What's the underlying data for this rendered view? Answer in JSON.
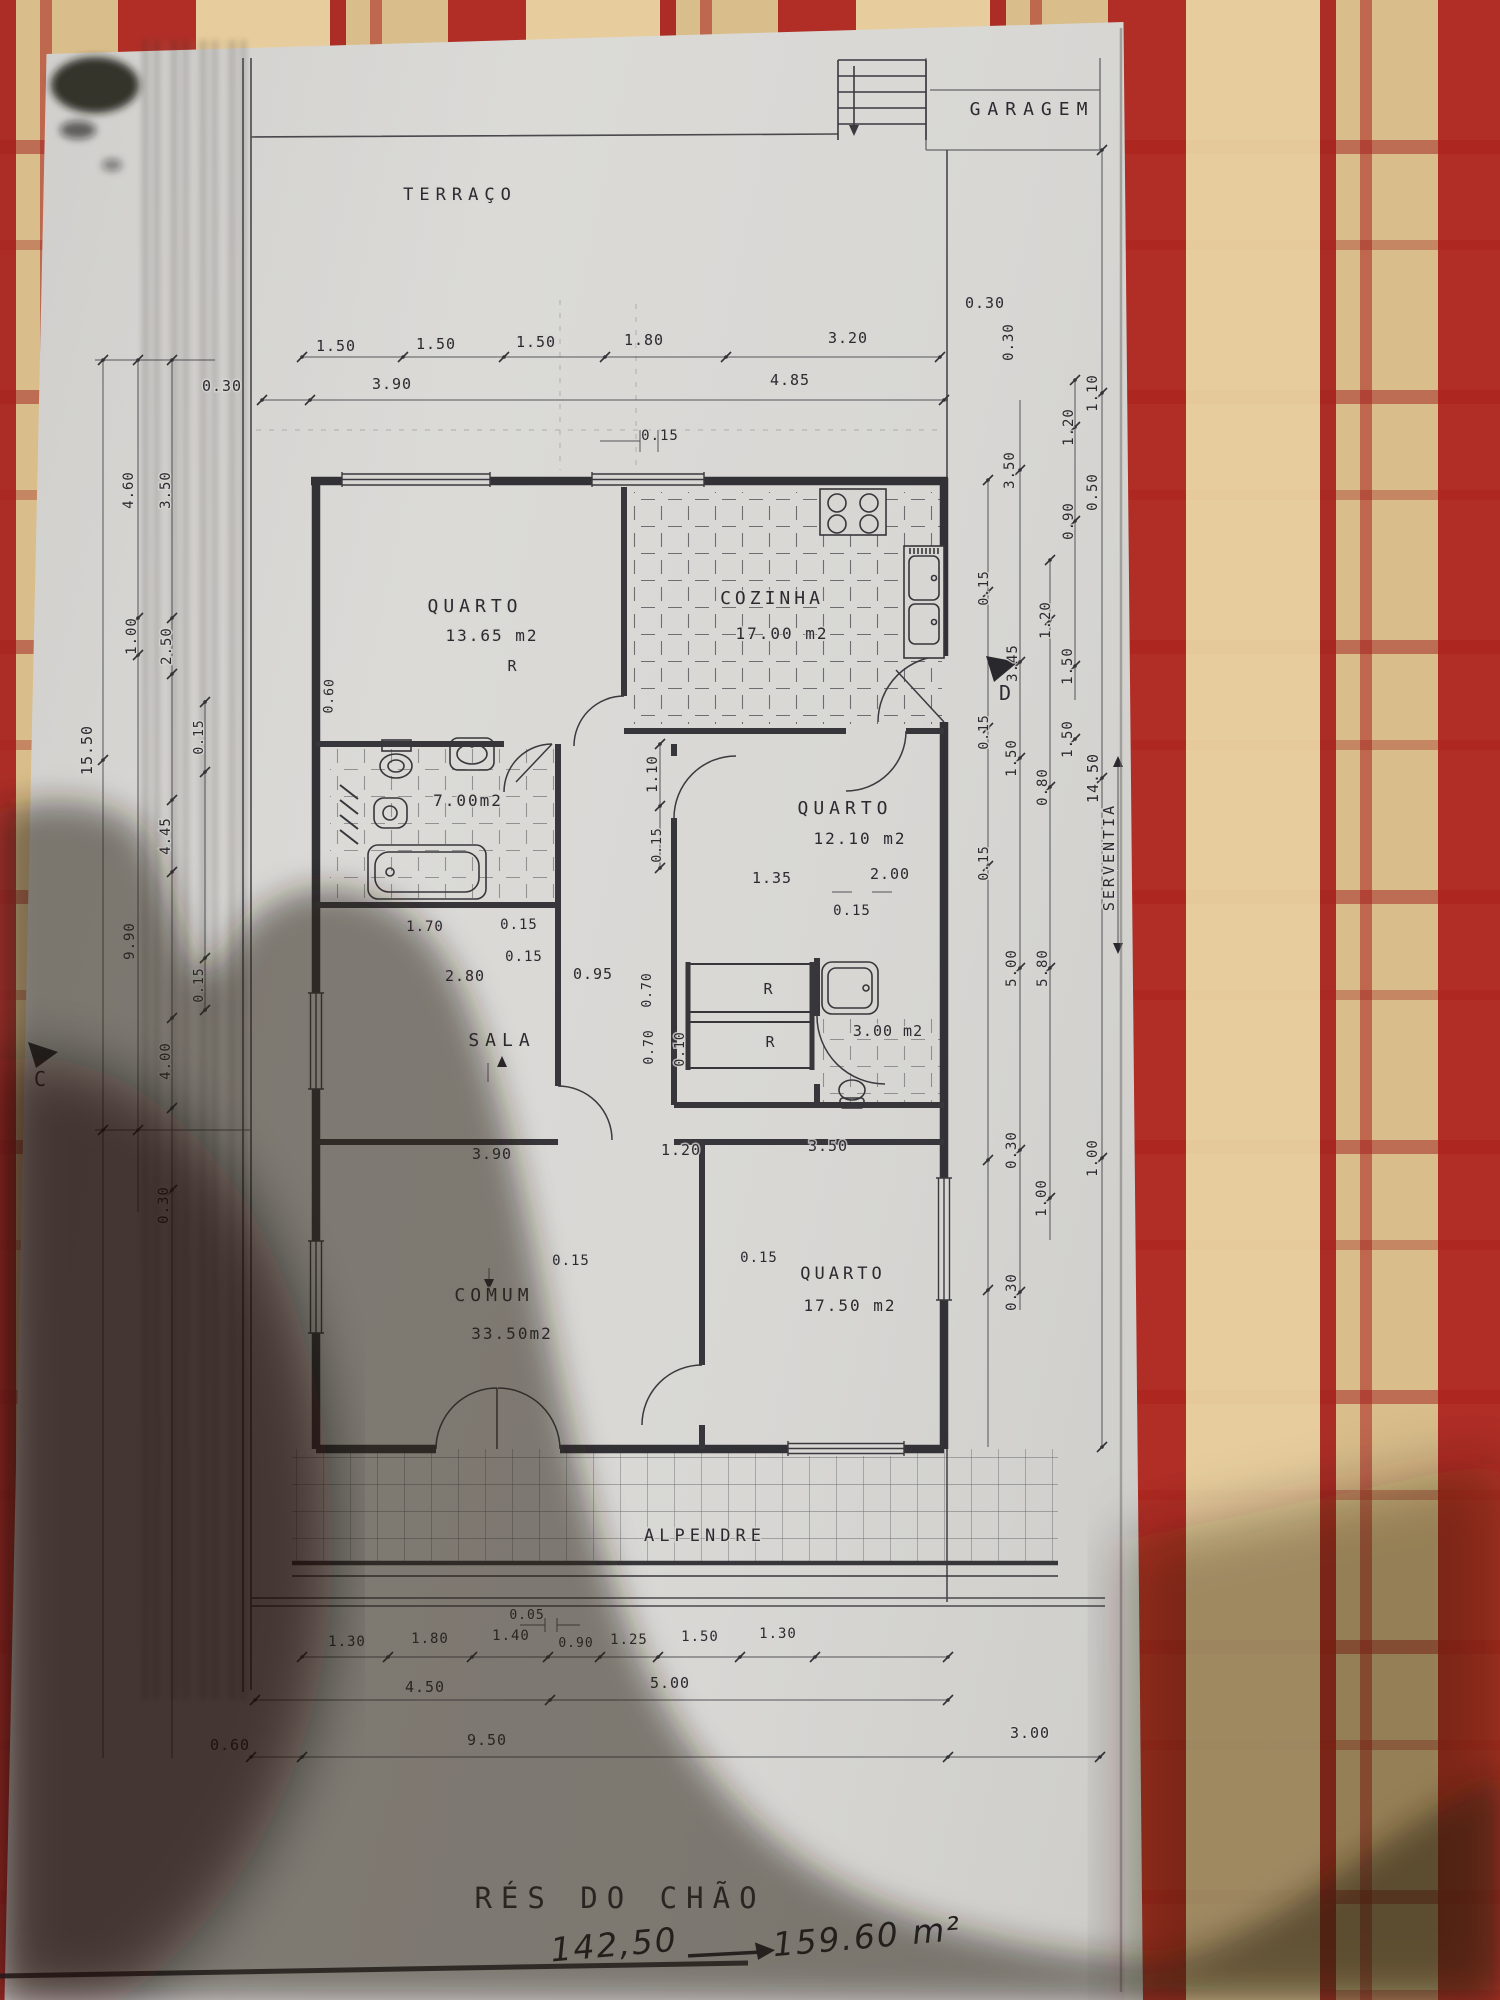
{
  "plan": {
    "title": "RÉS DO CHÃO",
    "handwriting": {
      "before_value": "142,50",
      "after_value": "159.60 m²"
    },
    "room_labels": [
      "GARAGEM",
      "TERRAÇO",
      "QUARTO 13.65 m2",
      "COZINHA 17.00 m2",
      "7.00m2",
      "QUARTO 12.10 m2",
      "SALA",
      "3.00 m2",
      "COMUM 33.50m2",
      "QUARTO 17.50 m2",
      "ALPENDRE",
      "SERVENTIA"
    ],
    "section_markers": [
      "C",
      "D"
    ],
    "labels": [
      {
        "id": "garagem-label",
        "text": "GARAGEM",
        "x": 1032,
        "y": 115,
        "rot": 0,
        "size": 18,
        "ls": 7
      },
      {
        "id": "terraco-label",
        "text": "TERRAÇO",
        "x": 460,
        "y": 200,
        "rot": 0,
        "size": 17,
        "ls": 6
      },
      {
        "id": "dim-150a",
        "text": "1.50",
        "x": 336,
        "y": 351,
        "rot": 0,
        "size": 15,
        "ls": 1
      },
      {
        "id": "dim-150b",
        "text": "1.50",
        "x": 436,
        "y": 349,
        "rot": 0,
        "size": 15,
        "ls": 1
      },
      {
        "id": "dim-150c",
        "text": "1.50",
        "x": 536,
        "y": 347,
        "rot": 0,
        "size": 15,
        "ls": 1
      },
      {
        "id": "dim-180",
        "text": "1.80",
        "x": 644,
        "y": 345,
        "rot": 0,
        "size": 15,
        "ls": 1
      },
      {
        "id": "dim-320",
        "text": "3.20",
        "x": 848,
        "y": 343,
        "rot": 0,
        "size": 15,
        "ls": 1
      },
      {
        "id": "dim-030-left",
        "text": "0.30",
        "x": 222,
        "y": 391,
        "rot": 0,
        "size": 15,
        "ls": 1
      },
      {
        "id": "dim-390",
        "text": "3.90",
        "x": 392,
        "y": 389,
        "rot": 0,
        "size": 15,
        "ls": 1
      },
      {
        "id": "dim-485",
        "text": "4.85",
        "x": 790,
        "y": 385,
        "rot": 0,
        "size": 15,
        "ls": 1
      },
      {
        "id": "dim-030-right-top",
        "text": "0.30",
        "x": 985,
        "y": 308,
        "rot": 0,
        "size": 15,
        "ls": 1
      },
      {
        "id": "dim-015-top",
        "text": "0.15",
        "x": 660,
        "y": 440,
        "rot": 0,
        "size": 14,
        "ls": 1
      },
      {
        "id": "quarto1-name",
        "text": "QUARTO",
        "x": 475,
        "y": 612,
        "rot": 0,
        "size": 18,
        "ls": 5
      },
      {
        "id": "quarto1-area",
        "text": "13.65 m2",
        "x": 492,
        "y": 641,
        "rot": 0,
        "size": 16,
        "ls": 2
      },
      {
        "id": "cozinha-name",
        "text": "COZINHA",
        "x": 772,
        "y": 604,
        "rot": 0,
        "size": 18,
        "ls": 4
      },
      {
        "id": "cozinha-area",
        "text": "17.00 m2",
        "x": 782,
        "y": 639,
        "rot": 0,
        "size": 16,
        "ls": 2
      },
      {
        "id": "wc1-area",
        "text": "7.00m2",
        "x": 468,
        "y": 806,
        "rot": 0,
        "size": 16,
        "ls": 2
      },
      {
        "id": "quarto2-name",
        "text": "QUARTO",
        "x": 845,
        "y": 814,
        "rot": 0,
        "size": 18,
        "ls": 5
      },
      {
        "id": "quarto2-area",
        "text": "12.10 m2",
        "x": 860,
        "y": 844,
        "rot": 0,
        "size": 16,
        "ls": 2
      },
      {
        "id": "closet-r1",
        "text": "R",
        "x": 512,
        "y": 671,
        "rot": 0,
        "size": 15,
        "ls": 0
      },
      {
        "id": "closet-r2",
        "text": "R",
        "x": 768,
        "y": 994,
        "rot": 0,
        "size": 15,
        "ls": 0
      },
      {
        "id": "closet-r3",
        "text": "R",
        "x": 770,
        "y": 1047,
        "rot": 0,
        "size": 15,
        "ls": 0
      },
      {
        "id": "dim-110v",
        "text": "1.10",
        "x": 657,
        "y": 774,
        "rot": -90,
        "size": 14,
        "ls": 1
      },
      {
        "id": "dim-015v",
        "text": "0.15",
        "x": 661,
        "y": 845,
        "rot": -90,
        "size": 13,
        "ls": 1
      },
      {
        "id": "dim-135",
        "text": "1.35",
        "x": 772,
        "y": 883,
        "rot": 0,
        "size": 15,
        "ls": 1
      },
      {
        "id": "dim-200",
        "text": "2.00",
        "x": 890,
        "y": 879,
        "rot": 0,
        "size": 15,
        "ls": 1
      },
      {
        "id": "dim-015c",
        "text": "0.15",
        "x": 852,
        "y": 915,
        "rot": 0,
        "size": 14,
        "ls": 1
      },
      {
        "id": "dim-170",
        "text": "1.70",
        "x": 425,
        "y": 931,
        "rot": 0,
        "size": 14,
        "ls": 1
      },
      {
        "id": "dim-015a",
        "text": "0.15",
        "x": 519,
        "y": 929,
        "rot": 0,
        "size": 14,
        "ls": 1
      },
      {
        "id": "dim-015b",
        "text": "0.15",
        "x": 524,
        "y": 961,
        "rot": 0,
        "size": 14,
        "ls": 1
      },
      {
        "id": "dim-280",
        "text": "2.80",
        "x": 465,
        "y": 981,
        "rot": 0,
        "size": 15,
        "ls": 1
      },
      {
        "id": "dim-095",
        "text": "0.95",
        "x": 593,
        "y": 979,
        "rot": 0,
        "size": 15,
        "ls": 1
      },
      {
        "id": "sala-name",
        "text": "SALA",
        "x": 502,
        "y": 1046,
        "rot": 0,
        "size": 18,
        "ls": 6
      },
      {
        "id": "wc2-area",
        "text": "3.00 m2",
        "x": 888,
        "y": 1036,
        "rot": 0,
        "size": 15,
        "ls": 1
      },
      {
        "id": "dim-070a",
        "text": "0.70",
        "x": 651,
        "y": 990,
        "rot": -90,
        "size": 13,
        "ls": 1
      },
      {
        "id": "dim-070b",
        "text": "0.70",
        "x": 653,
        "y": 1047,
        "rot": -90,
        "size": 13,
        "ls": 1
      },
      {
        "id": "dim-010",
        "text": "0.10",
        "x": 684,
        "y": 1049,
        "rot": -90,
        "size": 13,
        "ls": 1
      },
      {
        "id": "dim-390b",
        "text": "3.90",
        "x": 492,
        "y": 1159,
        "rot": 0,
        "size": 15,
        "ls": 1
      },
      {
        "id": "dim-120b",
        "text": "1.20",
        "x": 681,
        "y": 1155,
        "rot": 0,
        "size": 15,
        "ls": 1
      },
      {
        "id": "dim-350b",
        "text": "3.50",
        "x": 828,
        "y": 1151,
        "rot": 0,
        "size": 15,
        "ls": 1
      },
      {
        "id": "dim-015d",
        "text": "0.15",
        "x": 571,
        "y": 1265,
        "rot": 0,
        "size": 14,
        "ls": 1
      },
      {
        "id": "dim-015e",
        "text": "0.15",
        "x": 759,
        "y": 1262,
        "rot": 0,
        "size": 14,
        "ls": 1
      },
      {
        "id": "comum-name",
        "text": "COMUM",
        "x": 494,
        "y": 1301,
        "rot": 0,
        "size": 18,
        "ls": 5
      },
      {
        "id": "comum-area",
        "text": "33.50m2",
        "x": 512,
        "y": 1339,
        "rot": 0,
        "size": 16,
        "ls": 2
      },
      {
        "id": "quarto3-name",
        "text": "QUARTO",
        "x": 843,
        "y": 1279,
        "rot": 0,
        "size": 17,
        "ls": 4
      },
      {
        "id": "quarto3-area",
        "text": "17.50 m2",
        "x": 850,
        "y": 1311,
        "rot": 0,
        "size": 16,
        "ls": 2
      },
      {
        "id": "alpendre-name",
        "text": "ALPENDRE",
        "x": 705,
        "y": 1541,
        "rot": 0,
        "size": 17,
        "ls": 5
      },
      {
        "id": "dim-005",
        "text": "0.05",
        "x": 527,
        "y": 1619,
        "rot": 0,
        "size": 13,
        "ls": 1
      },
      {
        "id": "dim-130a",
        "text": "1.30",
        "x": 347,
        "y": 1646,
        "rot": 0,
        "size": 14,
        "ls": 1
      },
      {
        "id": "dim-180b",
        "text": "1.80",
        "x": 430,
        "y": 1643,
        "rot": 0,
        "size": 14,
        "ls": 1
      },
      {
        "id": "dim-140",
        "text": "1.40",
        "x": 511,
        "y": 1640,
        "rot": 0,
        "size": 14,
        "ls": 1
      },
      {
        "id": "dim-090b",
        "text": "0.90",
        "x": 576,
        "y": 1647,
        "rot": 0,
        "size": 13,
        "ls": 1
      },
      {
        "id": "dim-125",
        "text": "1.25",
        "x": 629,
        "y": 1644,
        "rot": 0,
        "size": 14,
        "ls": 1
      },
      {
        "id": "dim-150d",
        "text": "1.50",
        "x": 700,
        "y": 1641,
        "rot": 0,
        "size": 14,
        "ls": 1
      },
      {
        "id": "dim-130b",
        "text": "1.30",
        "x": 778,
        "y": 1638,
        "rot": 0,
        "size": 14,
        "ls": 1
      },
      {
        "id": "dim-450",
        "text": "4.50",
        "x": 425,
        "y": 1692,
        "rot": 0,
        "size": 15,
        "ls": 1
      },
      {
        "id": "dim-500",
        "text": "5.00",
        "x": 670,
        "y": 1688,
        "rot": 0,
        "size": 15,
        "ls": 1
      },
      {
        "id": "dim-060",
        "text": "0.60",
        "x": 230,
        "y": 1750,
        "rot": 0,
        "size": 15,
        "ls": 1
      },
      {
        "id": "dim-950",
        "text": "9.50",
        "x": 487,
        "y": 1745,
        "rot": 0,
        "size": 15,
        "ls": 1
      },
      {
        "id": "dim-300",
        "text": "3.00",
        "x": 1030,
        "y": 1738,
        "rot": 0,
        "size": 15,
        "ls": 1
      },
      {
        "id": "dimL-460",
        "text": "4.60",
        "x": 133,
        "y": 490,
        "rot": -90,
        "size": 14,
        "ls": 1
      },
      {
        "id": "dimL-350",
        "text": "3.50",
        "x": 170,
        "y": 490,
        "rot": -90,
        "size": 14,
        "ls": 1
      },
      {
        "id": "dimL-060",
        "text": "0.60",
        "x": 333,
        "y": 696,
        "rot": -88,
        "size": 13,
        "ls": 1
      },
      {
        "id": "dimL-100",
        "text": "1.00",
        "x": 136,
        "y": 636,
        "rot": -90,
        "size": 14,
        "ls": 1
      },
      {
        "id": "dimL-250",
        "text": "2.50",
        "x": 171,
        "y": 646,
        "rot": -90,
        "size": 14,
        "ls": 1
      },
      {
        "id": "dimL-015a",
        "text": "0.15",
        "x": 203,
        "y": 737,
        "rot": -90,
        "size": 13,
        "ls": 1
      },
      {
        "id": "dimL-1550",
        "text": "15.50",
        "x": 92,
        "y": 750,
        "rot": -90,
        "size": 15,
        "ls": 1
      },
      {
        "id": "dimL-445",
        "text": "4.45",
        "x": 170,
        "y": 836,
        "rot": -90,
        "size": 14,
        "ls": 1
      },
      {
        "id": "dimL-990",
        "text": "9.90",
        "x": 134,
        "y": 941,
        "rot": -90,
        "size": 14,
        "ls": 1
      },
      {
        "id": "dimL-015b",
        "text": "0.15",
        "x": 203,
        "y": 985,
        "rot": -90,
        "size": 13,
        "ls": 1
      },
      {
        "id": "dimL-400",
        "text": "4.00",
        "x": 170,
        "y": 1061,
        "rot": -90,
        "size": 14,
        "ls": 1
      },
      {
        "id": "dimL-030",
        "text": "0.30",
        "x": 168,
        "y": 1205,
        "rot": -90,
        "size": 14,
        "ls": 1
      },
      {
        "id": "marker-c",
        "text": "C",
        "x": 40,
        "y": 1086,
        "rot": 0,
        "size": 20,
        "ls": 0
      },
      {
        "id": "marker-d",
        "text": "D",
        "x": 1005,
        "y": 700,
        "rot": 0,
        "size": 20,
        "ls": 0
      },
      {
        "id": "dimR-030a",
        "text": "0.30",
        "x": 1013,
        "y": 342,
        "rot": -90,
        "size": 14,
        "ls": 1
      },
      {
        "id": "dimR-110",
        "text": "1.10",
        "x": 1097,
        "y": 393,
        "rot": -90,
        "size": 14,
        "ls": 1
      },
      {
        "id": "dimR-120a",
        "text": "1.20",
        "x": 1073,
        "y": 427,
        "rot": -90,
        "size": 14,
        "ls": 1
      },
      {
        "id": "dimR-350",
        "text": "3.50",
        "x": 1014,
        "y": 470,
        "rot": -90,
        "size": 14,
        "ls": 1
      },
      {
        "id": "dimR-050",
        "text": "0.50",
        "x": 1097,
        "y": 492,
        "rot": -90,
        "size": 14,
        "ls": 1
      },
      {
        "id": "dimR-090",
        "text": "0.90",
        "x": 1073,
        "y": 521,
        "rot": -90,
        "size": 14,
        "ls": 1
      },
      {
        "id": "dimR-120b",
        "text": "1.20",
        "x": 1050,
        "y": 620,
        "rot": -90,
        "size": 14,
        "ls": 1
      },
      {
        "id": "dimR-015a",
        "text": "0.15",
        "x": 988,
        "y": 588,
        "rot": -90,
        "size": 13,
        "ls": 1
      },
      {
        "id": "dimR-345",
        "text": "3.45",
        "x": 1017,
        "y": 663,
        "rot": -90,
        "size": 14,
        "ls": 1
      },
      {
        "id": "dimR-150a",
        "text": "1.50",
        "x": 1072,
        "y": 666,
        "rot": -90,
        "size": 14,
        "ls": 1
      },
      {
        "id": "dimR-015b",
        "text": "0.15",
        "x": 988,
        "y": 732,
        "rot": -90,
        "size": 13,
        "ls": 1
      },
      {
        "id": "dimR-150b",
        "text": "1.50",
        "x": 1016,
        "y": 758,
        "rot": -90,
        "size": 14,
        "ls": 1
      },
      {
        "id": "dimR-150c",
        "text": "1.50",
        "x": 1072,
        "y": 739,
        "rot": -90,
        "size": 14,
        "ls": 1
      },
      {
        "id": "dimR-080",
        "text": "0.80",
        "x": 1047,
        "y": 787,
        "rot": -90,
        "size": 14,
        "ls": 1
      },
      {
        "id": "dimR-1450",
        "text": "14.50",
        "x": 1098,
        "y": 778,
        "rot": -90,
        "size": 15,
        "ls": 1
      },
      {
        "id": "dimR-015c",
        "text": "0.15",
        "x": 988,
        "y": 863,
        "rot": -90,
        "size": 13,
        "ls": 1
      },
      {
        "id": "dimR-500",
        "text": "5.00",
        "x": 1016,
        "y": 968,
        "rot": -90,
        "size": 14,
        "ls": 1
      },
      {
        "id": "dimR-580",
        "text": "5.80",
        "x": 1047,
        "y": 968,
        "rot": -90,
        "size": 14,
        "ls": 1
      },
      {
        "id": "serventia-label",
        "text": "SERVENTIA",
        "x": 1114,
        "y": 857,
        "rot": -90,
        "size": 15,
        "ls": 3
      },
      {
        "id": "dimR-030b",
        "text": "0.30",
        "x": 1016,
        "y": 1150,
        "rot": -90,
        "size": 14,
        "ls": 1
      },
      {
        "id": "dimR-100a",
        "text": "1.00",
        "x": 1097,
        "y": 1158,
        "rot": -90,
        "size": 14,
        "ls": 1
      },
      {
        "id": "dimR-100b",
        "text": "1.00",
        "x": 1046,
        "y": 1198,
        "rot": -90,
        "size": 14,
        "ls": 1
      },
      {
        "id": "dimR-030c",
        "text": "0.30",
        "x": 1016,
        "y": 1292,
        "rot": -90,
        "size": 14,
        "ls": 1
      },
      {
        "id": "floor-title",
        "text": "RÉS DO CHÃO",
        "x": 620,
        "y": 1908,
        "rot": 0,
        "size": 29,
        "ls": 9
      },
      {
        "id": "hw-before",
        "text": "142,50",
        "x": 615,
        "y": 1956,
        "rot": -5,
        "size": 33,
        "ls": 2,
        "hand": true
      },
      {
        "id": "hw-after",
        "text": "159.60 m²",
        "x": 868,
        "y": 1948,
        "rot": -5,
        "size": 33,
        "ls": 2,
        "hand": true
      }
    ]
  }
}
